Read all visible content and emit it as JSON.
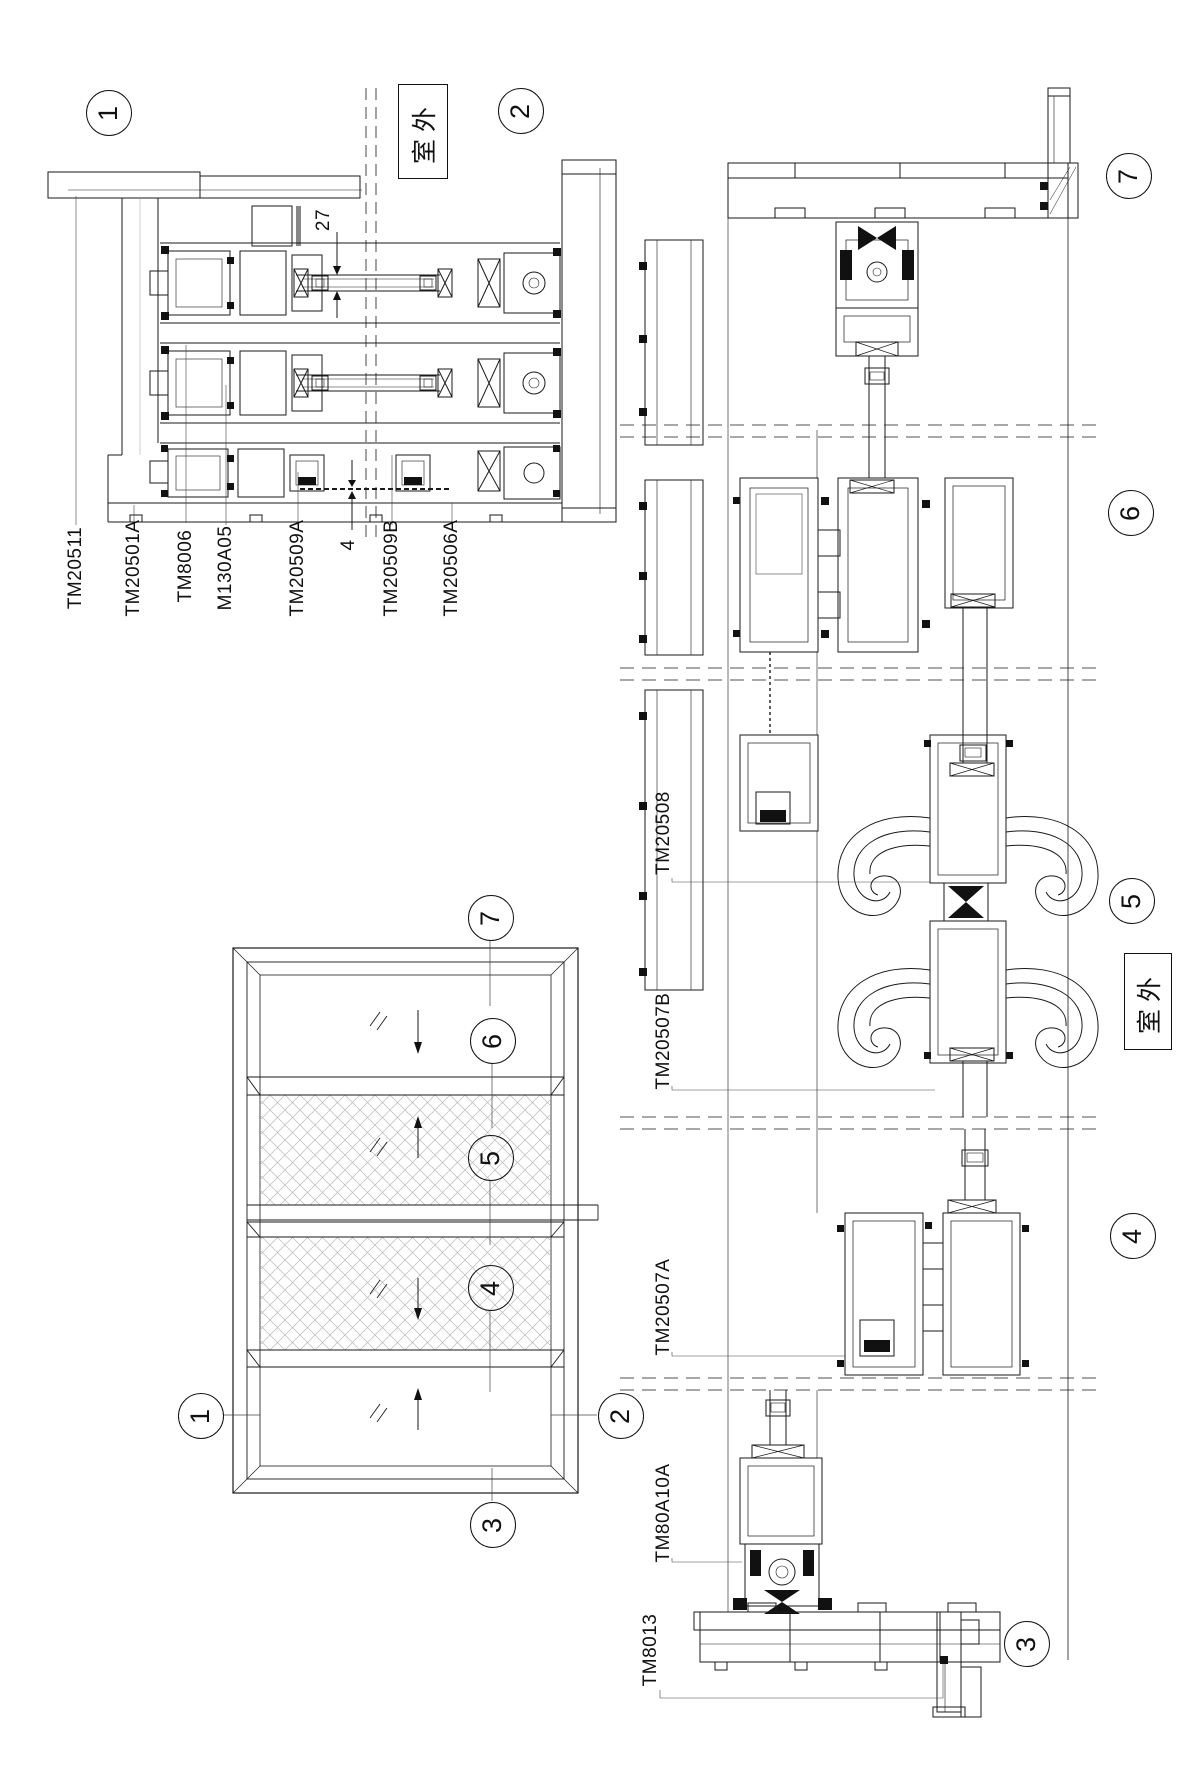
{
  "section_a": {
    "callouts": [
      "1",
      "2"
    ],
    "outdoor_label": "室外",
    "dimensions": [
      "27",
      "4"
    ],
    "part_labels": [
      "TM20511",
      "TM20501A",
      "TM8006",
      "M130A05",
      "TM20509A",
      "TM20509B",
      "TM20506A"
    ]
  },
  "elevation": {
    "callouts": [
      "7",
      "6",
      "5",
      "4",
      "1",
      "2",
      "3"
    ]
  },
  "section_b": {
    "outdoor_label": "室外",
    "callouts": [
      "7",
      "6",
      "5",
      "4",
      "3"
    ],
    "part_labels": [
      "TM20508",
      "TM20507B",
      "TM20507A",
      "TM80A10A",
      "TM8013"
    ]
  }
}
